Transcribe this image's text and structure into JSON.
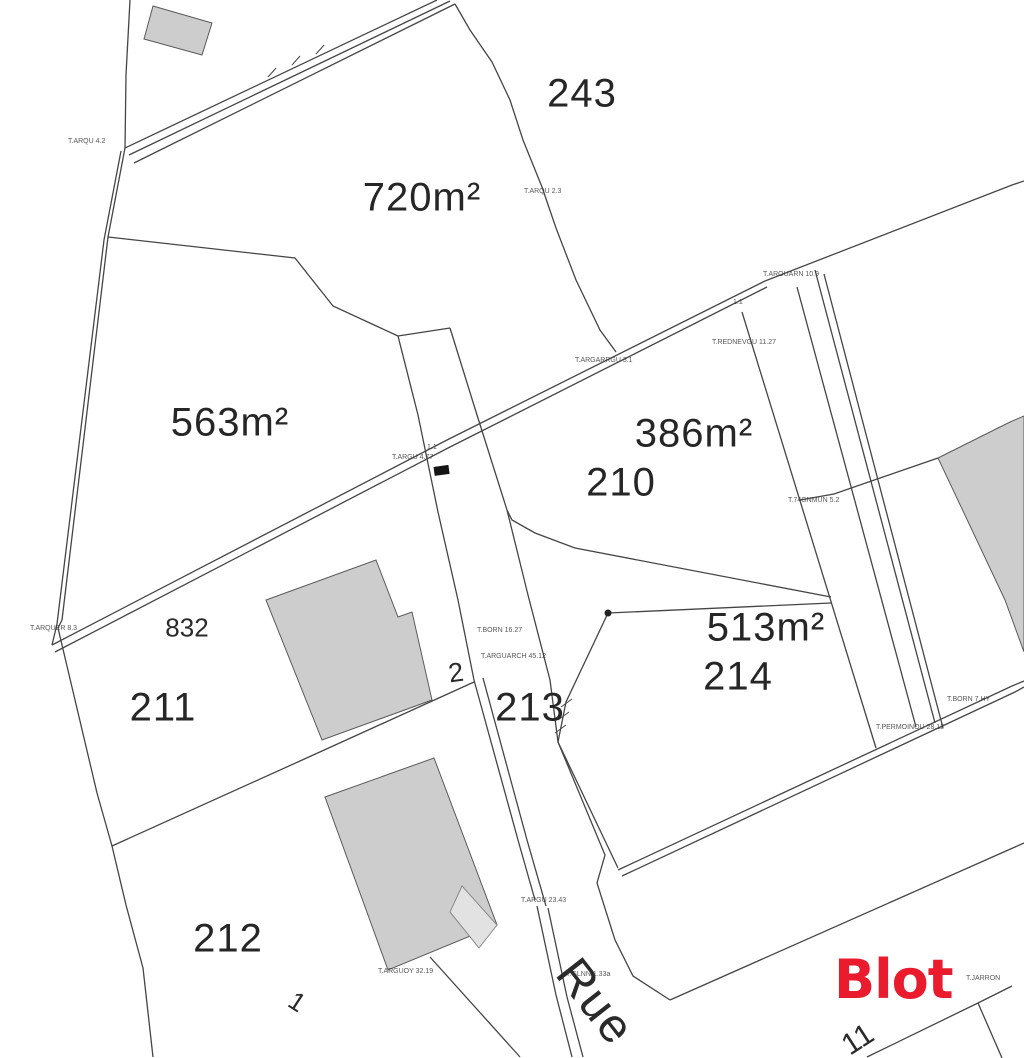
{
  "document": {
    "type": "cadastral plan (plan de bornage)"
  },
  "brand": {
    "logo_text": "Blot",
    "color": "#EA1B2C"
  },
  "street": {
    "name": "Rue"
  },
  "parcels": {
    "p243": "243",
    "p210": "210",
    "p832": "832",
    "p211": "211",
    "p213": "213",
    "p214": "214",
    "p212": "212",
    "p2": "2",
    "p1": "1",
    "p11": "11"
  },
  "areas": {
    "a720": "720m²",
    "a563": "563m²",
    "a386": "386m²",
    "a513": "513m²"
  },
  "survey_markers": {
    "m1": "T.ARQU 4.2",
    "m2": "T.ARQU 2.3",
    "m3": "T.AROUARN 10.9",
    "m4": "T.REDNEVGU 11.27",
    "m5": "T.ARGARRGU 3.1",
    "m6": "T.ARGU 4.77",
    "m7": "T.74GNMUN 5.2",
    "m8": "T.ARQUER 8.3",
    "m9": "T.BORN 16.27",
    "m10": "T.ARGUARCH 45.12",
    "m11": "T.BORN 7.HY",
    "m12": "T.PERMOINOU 28.12",
    "m13": "T.ARGU 23.43",
    "m14": "T.GLNN 1.33a",
    "m15": "T.ARGUOY 32.19",
    "m16": "T.JARRON",
    "m17": "1.1",
    "m18": "1.1"
  },
  "colors": {
    "boundary_line": "#454545",
    "building_fill": "#cdcdcd",
    "building_stroke": "#5a5a5a",
    "brand_red": "#EA1B2C",
    "background": "#ffffff"
  }
}
